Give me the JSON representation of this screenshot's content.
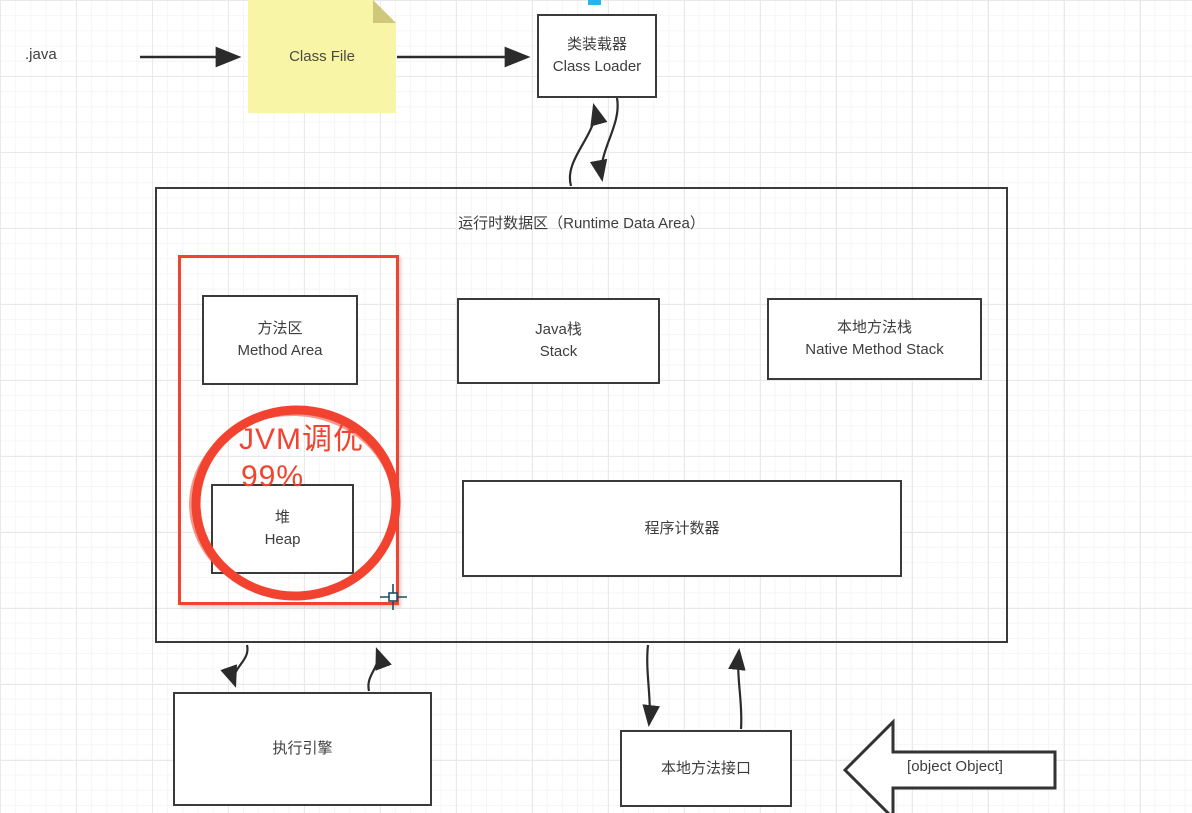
{
  "diagram": {
    "source_label": ".java",
    "class_file_note": "Class File",
    "class_loader": {
      "zh": "类装载器",
      "en": "Class Loader"
    },
    "runtime_data_area": {
      "title": "运行时数据区（Runtime Data Area）"
    },
    "method_area": {
      "zh": "方法区",
      "en": "Method Area"
    },
    "java_stack": {
      "zh": "Java栈",
      "en": "Stack"
    },
    "native_method_stack": {
      "zh": "本地方法栈",
      "en": "Native Method Stack"
    },
    "heap": {
      "zh": "堆",
      "en": "Heap"
    },
    "program_counter": {
      "zh": "程序计数器"
    },
    "execution_engine": {
      "zh": "执行引擎"
    },
    "native_method_interface": {
      "zh": "本地方法接口"
    },
    "native_method_library": {
      "zh": "本地方法库"
    },
    "annotation": {
      "line1": "JVM调优",
      "line2": "99%"
    },
    "colors": {
      "highlight_red": "#f1432f",
      "note_yellow": "#f8f5a6",
      "note_fold": "#cfc87b",
      "handle_cyan": "#29b2ee",
      "box_border": "#3a3a3a",
      "text": "#3d3d3d"
    }
  }
}
